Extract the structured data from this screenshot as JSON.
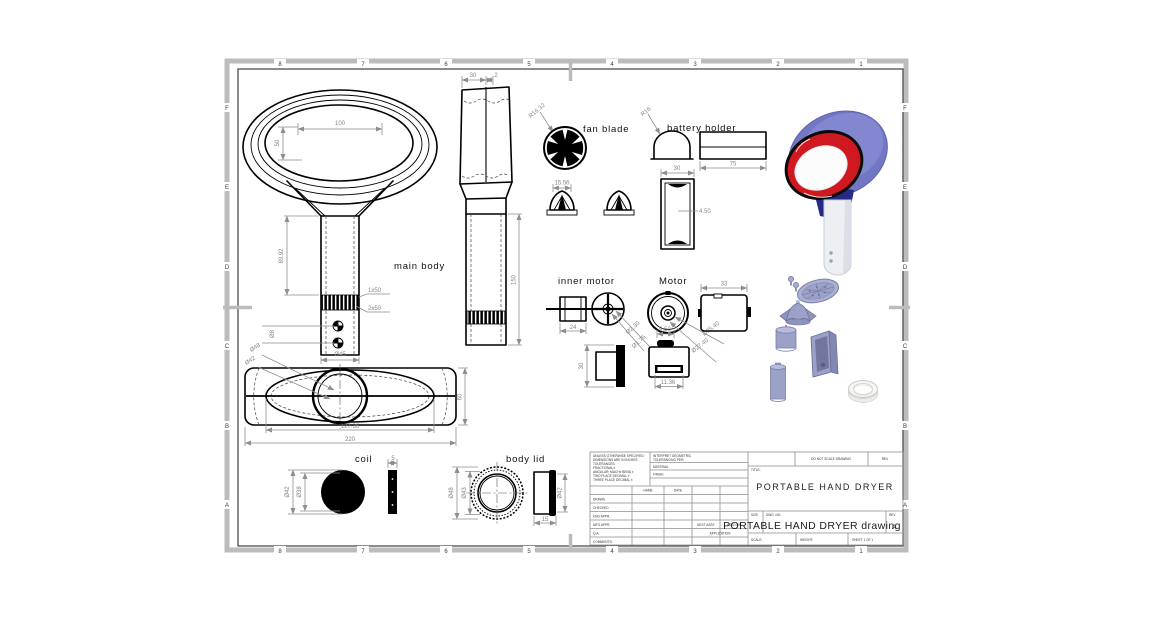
{
  "sheet": {
    "zone_cols": [
      "8",
      "7",
      "6",
      "5",
      "4",
      "3",
      "2",
      "1"
    ],
    "zone_rows": [
      "F",
      "E",
      "D",
      "C",
      "B",
      "A"
    ]
  },
  "labels": {
    "main_body": "main body",
    "fan_blade": "fan blade",
    "battery_holder": "battery holder",
    "inner_motor": "inner motor",
    "motor": "Motor",
    "coil": "coil",
    "body_lid": "body lid"
  },
  "dims": {
    "top_view_width": "100",
    "top_view_height": "50",
    "front_height": "89.92",
    "front_hole_dia": "Ø8",
    "front_handle_dia": "Ø45",
    "front_knurl1": "1x50",
    "front_knurl2": "2x50",
    "side_top_width": "30",
    "side_wall": "2",
    "side_handle_len": "150",
    "bottom_outer_dia": "Ø48",
    "bottom_inner_dia": "Ø42",
    "bottom_opening_len": "127.36",
    "bottom_total_len": "220",
    "bottom_depth": "60",
    "fan_radius": "R16.32",
    "fan_hub_width": "15.56",
    "holder_radius": "R16",
    "holder_len": "75",
    "holder_width": "30",
    "holder_wall": "4.50",
    "inner_motor_len": "24",
    "inner_shaft_dia1": "Ø2.30",
    "inner_shaft_dia2": "Ø1.75",
    "inner_motor_height": "30",
    "motor_len": "33",
    "motor_dia1": "Ø25.40",
    "motor_dia2": "Ø27.40",
    "motor_boss": "9.50",
    "motor_slot": "11.36",
    "coil_outer_dia": "Ø42",
    "coil_inner_dia": "Ø38",
    "coil_thickness": "5",
    "lid_outer_dia": "Ø48",
    "lid_inner_dia": "Ø43",
    "lid_side_dia": "Ø42",
    "lid_depth": "15"
  },
  "title_block": {
    "tolerance_note": [
      "UNLESS OTHERWISE SPECIFIED:",
      "DIMENSIONS ARE IN INCHES",
      "TOLERANCES:",
      "FRACTIONAL±",
      "ANGULAR: MACH±  BEND ±",
      "TWO PLACE DECIMAL    ±",
      "THREE PLACE DECIMAL  ±"
    ],
    "interpret_note": "INTERPRET GEOMETRIC",
    "interpret_note2": "TOLERANCING PER:",
    "material_label": "MATERIAL",
    "finish_label": "FINISH",
    "name_header": "NAME",
    "date_header": "DATE",
    "rows": [
      "DRAWN",
      "CHECKED",
      "ENG APPR.",
      "MFG APPR.",
      "Q.A.",
      "COMMENTS:"
    ],
    "next_assy": "NEXT ASSY",
    "used_on": "USED ON",
    "application": "APPLICATION",
    "do_not_scale": "DO NOT SCALE DRAWING",
    "title_label": "TITLE:",
    "title": "PORTABLE HAND DRYER",
    "size_label": "SIZE",
    "dwg_no_label": "DWG. NO.",
    "dwg_no": "PORTABLE HAND DRYER drawing",
    "rev_label": "REV",
    "rev": "A",
    "scale_label": "SCALE:",
    "weight_label": "WEIGHT:",
    "sheet_label": "SHEET 1 OF 1"
  }
}
